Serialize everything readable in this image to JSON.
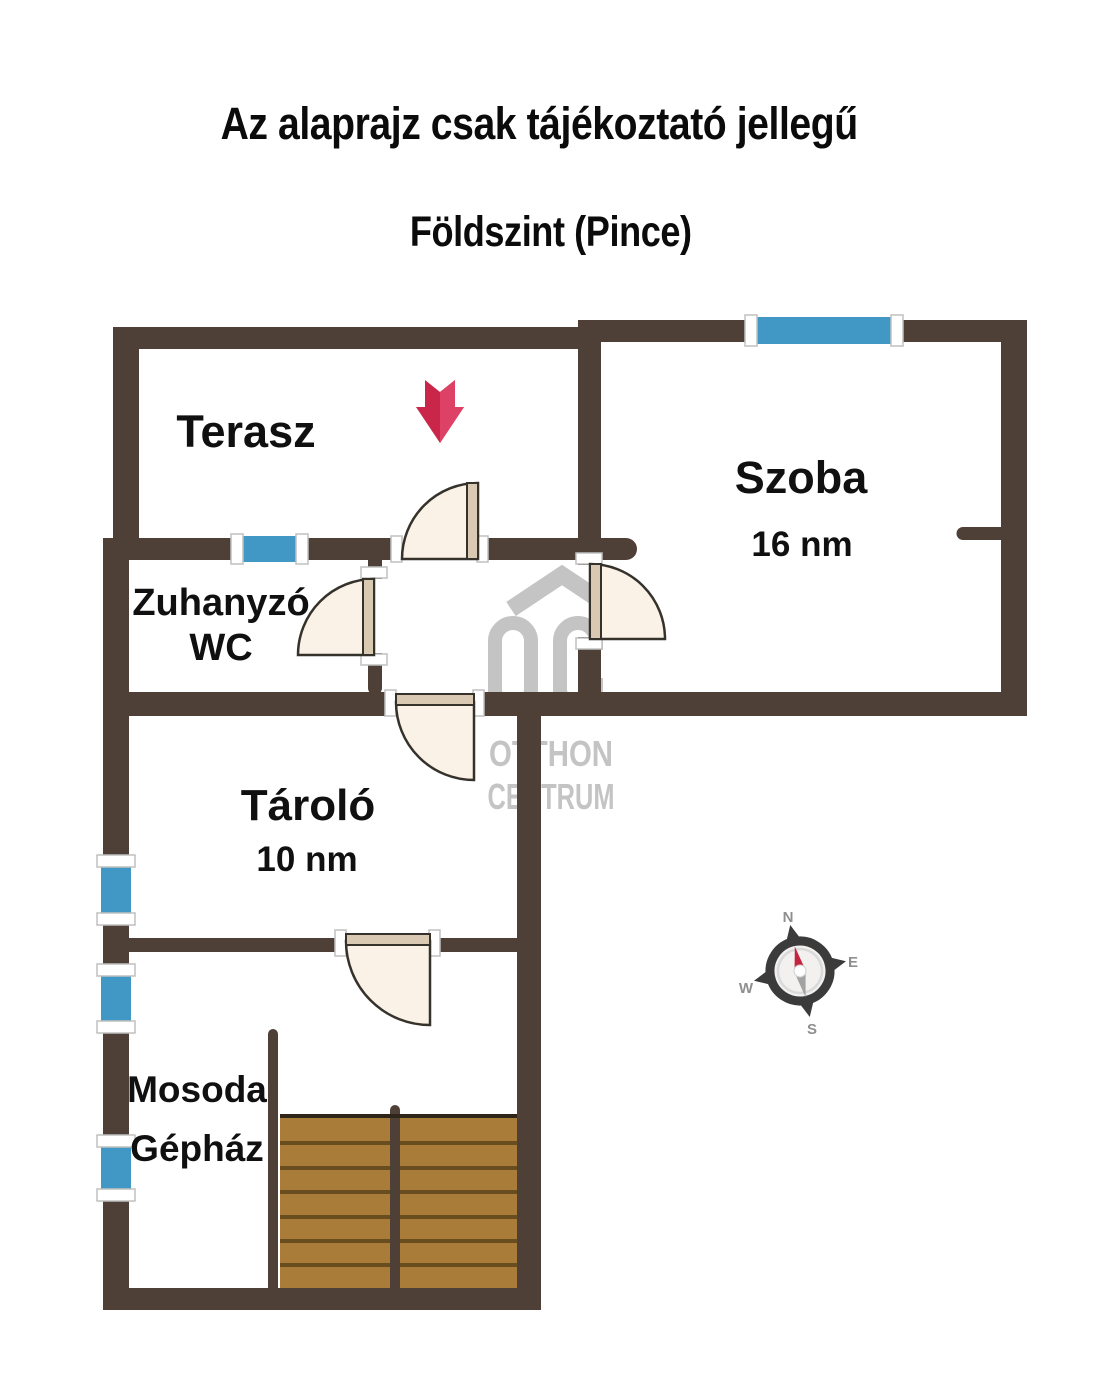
{
  "title": {
    "disclaimer": "Az alaprajz csak tájékoztató jellegű",
    "floor": "Földszint (Pince)"
  },
  "rooms": {
    "terasz": {
      "name": "Terasz"
    },
    "szoba": {
      "name": "Szoba",
      "area": "16 nm"
    },
    "zuhanyzo": {
      "name": "Zuhanyzó",
      "name2": "WC"
    },
    "tarolo": {
      "name": "Tároló",
      "area": "10 nm"
    },
    "mosoda": {
      "name": "Mosoda",
      "name2": "Gépház"
    }
  },
  "compass": {
    "north": "N",
    "east": "E",
    "west": "W",
    "south": "S"
  },
  "watermark": {
    "otthon": "OTTHON",
    "centrum": "CENTRUM"
  },
  "colors": {
    "wall": "#4e4037",
    "window": "#4298c5",
    "door_fill": "#faf2e6",
    "door_leaf": "#d9c9b3",
    "door_stroke": "#35312b",
    "arrow": "#c9264a",
    "arrow_light": "#dd4165",
    "stair_wood": "#aa7c3a",
    "stair_seam": "#6a4d1e",
    "stair_edge": "#2f2418",
    "watermark": "#c4c4c4",
    "compass_dark": "#3b3b3b",
    "compass_letter": "#8f8f8f",
    "needle_red": "#c4243e",
    "needle_gray": "#a3a2a2",
    "label": "#101010"
  }
}
